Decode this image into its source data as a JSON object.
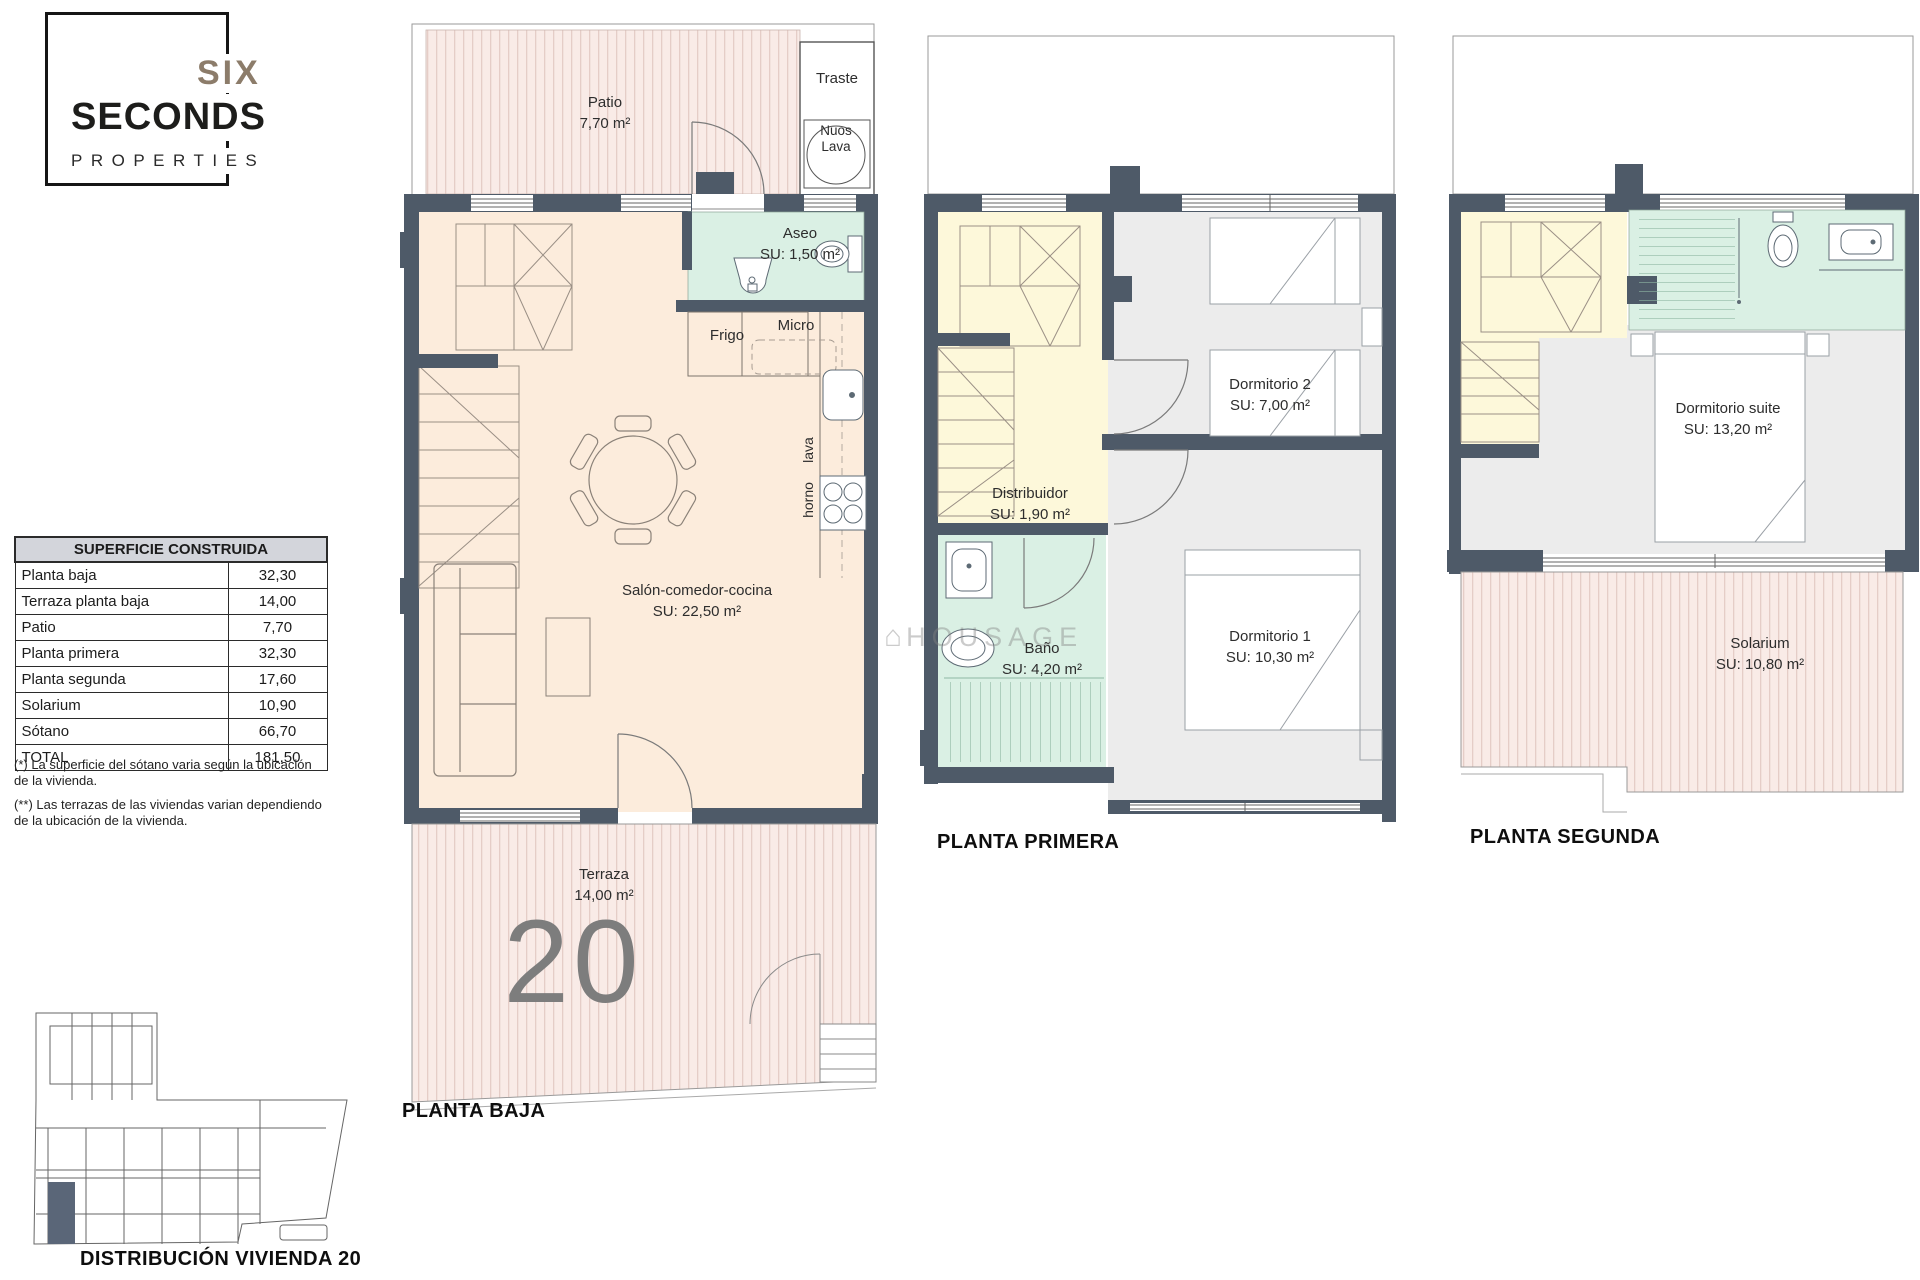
{
  "logo": {
    "six": "SIX",
    "seconds": "SECONDS",
    "properties": "PROPERTIES"
  },
  "watermark": {
    "text": "HOUSAGE",
    "house_icon": "⌂"
  },
  "area_table": {
    "title": "SUPERFICIE CONSTRUIDA",
    "rows": [
      {
        "label": "Planta baja",
        "value": "32,30"
      },
      {
        "label": "Terraza planta baja",
        "value": "14,00"
      },
      {
        "label": "Patio",
        "value": "7,70"
      },
      {
        "label": "Planta primera",
        "value": "32,30"
      },
      {
        "label": "Planta segunda",
        "value": "17,60"
      },
      {
        "label": "Solarium",
        "value": "10,90"
      },
      {
        "label": "Sótano",
        "value": "66,70"
      },
      {
        "label": "TOTAL",
        "value": "181,50"
      }
    ],
    "footnotes": [
      "(*) La superficie del sótano varia según la ubicación de la vivienda.",
      "(**) Las terrazas de las viviendas varian dependiendo de la ubicación de la vivienda."
    ]
  },
  "plans": {
    "planta_baja": {
      "title": "PLANTA BAJA",
      "unit_number": "20",
      "labels": {
        "patio_name": "Patio",
        "patio_area": "7,70 m²",
        "traste": "Traste",
        "nuos_line1": "Nuos",
        "nuos_line2": "Lava",
        "aseo_name": "Aseo",
        "aseo_area": "SU: 1,50 m²",
        "frigo": "Frigo",
        "micro": "Micro",
        "lava": "lava",
        "horno": "horno",
        "salon_name": "Salón-comedor-cocina",
        "salon_area": "SU: 22,50 m²",
        "terraza_name": "Terraza",
        "terraza_area": "14,00 m²"
      }
    },
    "planta_primera": {
      "title": "PLANTA PRIMERA",
      "labels": {
        "dormitorio2_name": "Dormitorio 2",
        "dormitorio2_area": "SU: 7,00 m²",
        "distribuidor_name": "Distribuidor",
        "distribuidor_area": "SU: 1,90 m²",
        "bano_name": "Baño",
        "bano_area": "SU: 4,20 m²",
        "dormitorio1_name": "Dormitorio 1",
        "dormitorio1_area": "SU: 10,30 m²"
      }
    },
    "planta_segunda": {
      "title": "PLANTA SEGUNDA",
      "labels": {
        "suite_name": "Dormitorio suite",
        "suite_area": "SU: 13,20 m²",
        "solarium_name": "Solarium",
        "solarium_area": "SU: 10,80 m²"
      }
    }
  },
  "site_plan": {
    "title": "DISTRIBUCIÓN VIVIENDA 20"
  },
  "colors": {
    "wall": "#4e5a68",
    "floor_peach": "#fcecdc",
    "terrace_pink": "#f9ebe7",
    "terrace_stripe": "#e5cdc7",
    "bath_mint": "#daf0e4",
    "stair_yellow": "#fdf8da",
    "bedroom_gray": "#ececec",
    "table_header_gray": "#d3d5db",
    "unit_number_gray": "#7d7d7d"
  }
}
